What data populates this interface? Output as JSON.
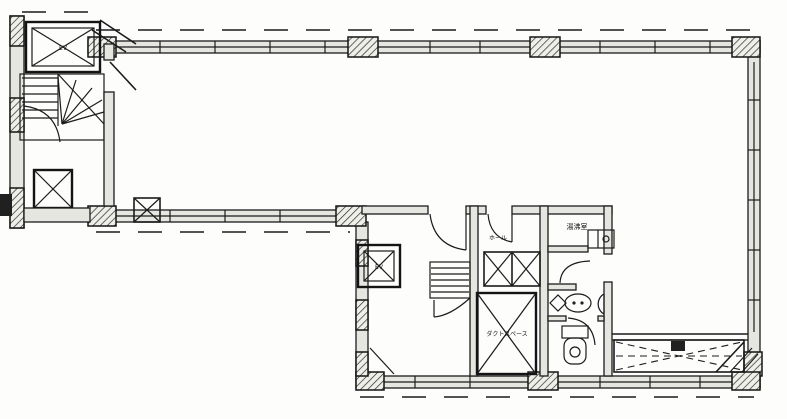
{
  "plan": {
    "type": "architectural-floor-plan",
    "labels": {
      "ev_upper": "EV",
      "ev_main": "EV",
      "duct_space": "ダクトスペース",
      "kitchenette": "湯沸室",
      "hall": "ホール"
    },
    "colors": {
      "line": "#1b1b1b",
      "background": "#fdfdfc",
      "wall_fill": "#e6e6e0"
    },
    "features": [
      "L-shaped open floor",
      "upper-left stair and elevator core",
      "central core with stair, elevator, duct space",
      "kitchenette room",
      "washroom with basin and WC",
      "bottom-right balcony strip with dashed cross"
    ]
  }
}
